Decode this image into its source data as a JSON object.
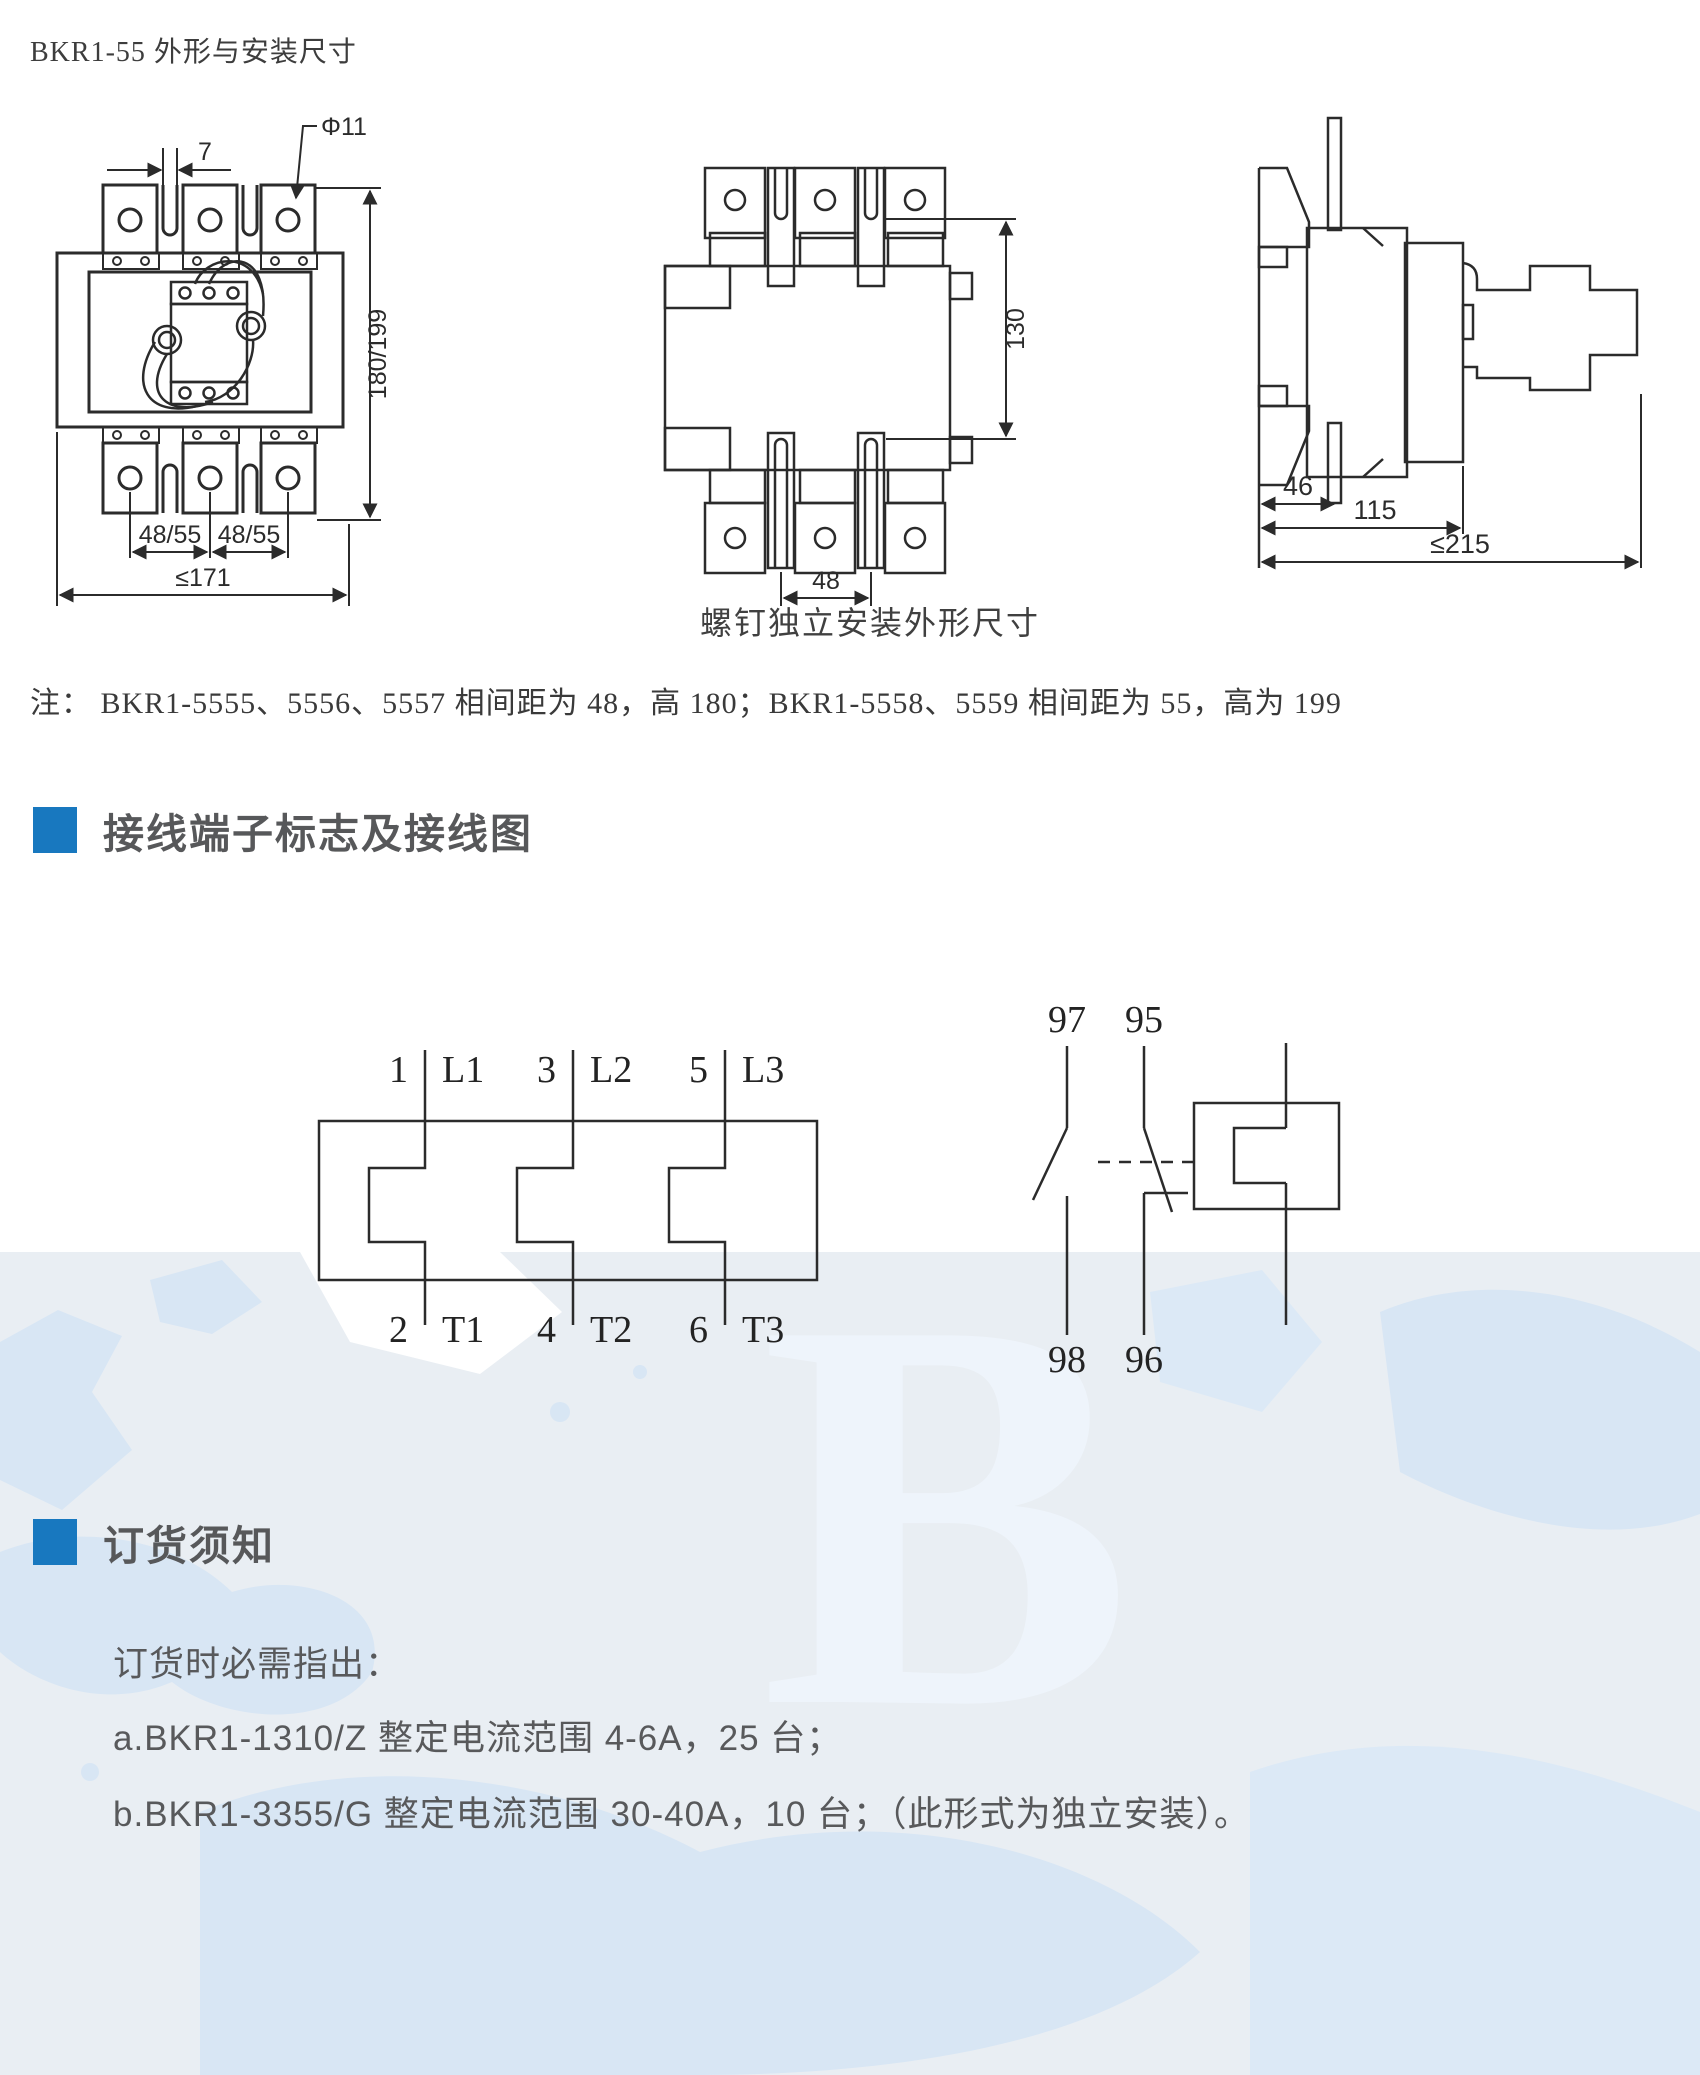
{
  "page": {
    "title": "BKR1-55 外形与安装尺寸",
    "caption": "螺钉独立安装外形尺寸",
    "note": "注：  BKR1-5555、5556、5557 相间距为 48，高 180；BKR1-5558、5559 相间距为 55，高为 199"
  },
  "colors": {
    "accent_blue": "#1878bf",
    "line": "#2b2b2b",
    "body_text": "#58595b",
    "map_base": "#e9eef3",
    "map_land": "#d8e6f4"
  },
  "front_view": {
    "dims": {
      "gap": "7",
      "hole": "Φ11",
      "height": "180/199",
      "pitch1": "48/55",
      "pitch2": "48/55",
      "width": "≤171"
    }
  },
  "mounting_view": {
    "dims": {
      "height": "130",
      "pitch": "48"
    }
  },
  "side_view": {
    "dims": {
      "d1": "46",
      "d2": "115",
      "d3": "≤215"
    }
  },
  "sections": {
    "wiring": "接线端子标志及接线图",
    "ordering": "订货须知"
  },
  "wiring": {
    "top_terminals": [
      {
        "num": "1",
        "name": "L1"
      },
      {
        "num": "3",
        "name": "L2"
      },
      {
        "num": "5",
        "name": "L3"
      }
    ],
    "bottom_terminals": [
      {
        "num": "2",
        "name": "T1"
      },
      {
        "num": "4",
        "name": "T2"
      },
      {
        "num": "6",
        "name": "T3"
      }
    ],
    "contacts": {
      "no_top": "97",
      "nc_top": "95",
      "no_bottom": "98",
      "nc_bottom": "96"
    }
  },
  "ordering": {
    "intro": "订货时必需指出：",
    "items": [
      "a.BKR1-1310/Z 整定电流范围 4-6A，25 台；",
      "b.BKR1-3355/G 整定电流范围 30-40A，10 台；（此形式为独立安装）。"
    ]
  }
}
